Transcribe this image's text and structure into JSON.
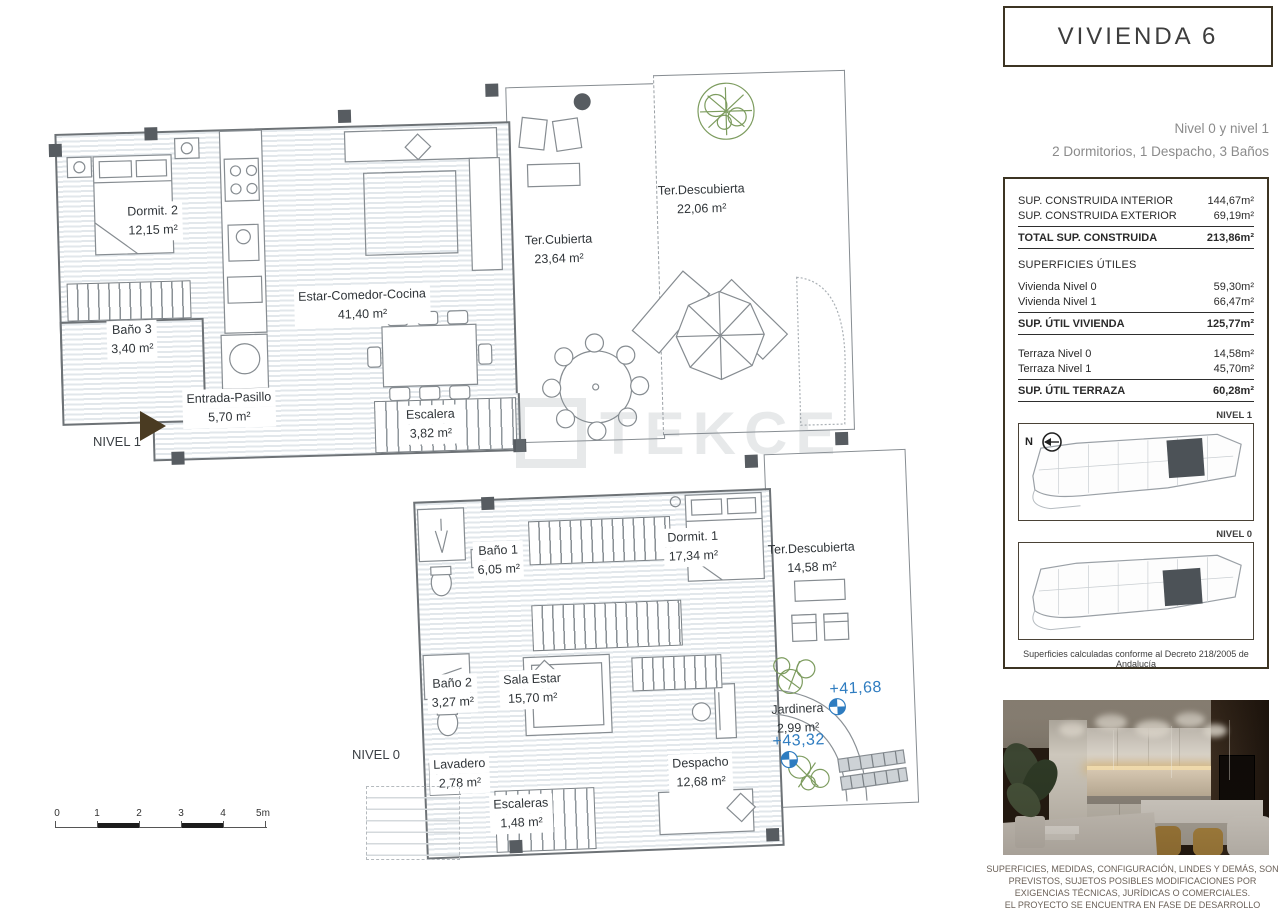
{
  "title_box": {
    "title": "VIVIENDA 6"
  },
  "subtitle": {
    "levels": "Nivel 0 y nivel 1",
    "config": "2 Dormitorios, 1 Despacho, 3 Baños"
  },
  "areas_panel": {
    "construida": [
      {
        "label": "SUP. CONSTRUIDA INTERIOR",
        "value": "144,67m²"
      },
      {
        "label": "SUP. CONSTRUIDA EXTERIOR",
        "value": "69,19m²"
      }
    ],
    "construida_total": {
      "label": "TOTAL SUP. CONSTRUIDA",
      "value": "213,86m²"
    },
    "utiles_header": "SUPERFICIES ÚTILES",
    "vivienda_rows": [
      {
        "label": "Vivienda Nivel 0",
        "value": "59,30m²"
      },
      {
        "label": "Vivienda Nivel 1",
        "value": "66,47m²"
      }
    ],
    "vivienda_total": {
      "label": "SUP. ÚTIL VIVIENDA",
      "value": "125,77m²"
    },
    "terraza_rows": [
      {
        "label": "Terraza Nivel 0",
        "value": "14,58m²"
      },
      {
        "label": "Terraza Nivel 1",
        "value": "45,70m²"
      }
    ],
    "terraza_total": {
      "label": "SUP. ÚTIL TERRAZA",
      "value": "60,28m²"
    },
    "footnote": "Superficies calculadas conforme al Decreto 218/2005 de Andalucía"
  },
  "site_plans": {
    "nivel1_label": "NIVEL 1",
    "nivel0_label": "NIVEL 0",
    "north_label": "N"
  },
  "plans": {
    "nivel1": {
      "name": "NIVEL 1",
      "rooms": {
        "dormitorio2": {
          "label": "Dormit. 2",
          "area": "12,15 m²"
        },
        "bano3": {
          "label": "Baño 3",
          "area": "3,40 m²"
        },
        "estar": {
          "label": "Estar-Comedor-Cocina",
          "area": "41,40 m²"
        },
        "entrada": {
          "label": "Entrada-Pasillo",
          "area": "5,70 m²"
        },
        "escalera": {
          "label": "Escalera",
          "area": "3,82 m²"
        },
        "ter_cubierta": {
          "label": "Ter.Cubierta",
          "area": "23,64 m²"
        },
        "ter_descubierta": {
          "label": "Ter.Descubierta",
          "area": "22,06 m²"
        }
      }
    },
    "nivel0": {
      "name": "NIVEL 0",
      "rooms": {
        "bano1": {
          "label": "Baño 1",
          "area": "6,05 m²"
        },
        "dormitorio1": {
          "label": "Dormit. 1",
          "area": "17,34 m²"
        },
        "ter_descubierta": {
          "label": "Ter.Descubierta",
          "area": "14,58 m²"
        },
        "bano2": {
          "label": "Baño 2",
          "area": "3,27 m²"
        },
        "sala_estar": {
          "label": "Sala Estar",
          "area": "15,70 m²"
        },
        "lavadero": {
          "label": "Lavadero",
          "area": "2,78 m²"
        },
        "escaleras": {
          "label": "Escaleras",
          "area": "1,48 m²"
        },
        "despacho": {
          "label": "Despacho",
          "area": "12,68 m²"
        },
        "jardinera": {
          "label": "Jardinera",
          "area": "2,99 m²"
        }
      },
      "elevations": {
        "upper": "+41,68",
        "lower": "+43,32"
      }
    }
  },
  "scale_bar": {
    "ticks": [
      "0",
      "1",
      "2",
      "3",
      "4",
      "5m"
    ]
  },
  "watermark": {
    "text": "TEKCE"
  },
  "disclaimer": {
    "line1": "SUPERFICIES, MEDIDAS, CONFIGURACIÓN, LINDES Y DEMÁS, SON",
    "line2": "PREVISTOS, SUJETOS POSIBLES MODIFICACIONES POR",
    "line3": "EXIGENCIAS TÉCNICAS, JURÍDICAS O COMERCIALES.",
    "line4": "EL PROYECTO SE ENCUENTRA EN FASE DE DESARROLLO"
  },
  "colors": {
    "accent_brown": "#3c3423",
    "elevation_blue": "#2e7cc0",
    "hatch_blue_gray": "#e2e7eb",
    "plan_line": "#6d7276",
    "plant_green": "#7d9c5f"
  }
}
